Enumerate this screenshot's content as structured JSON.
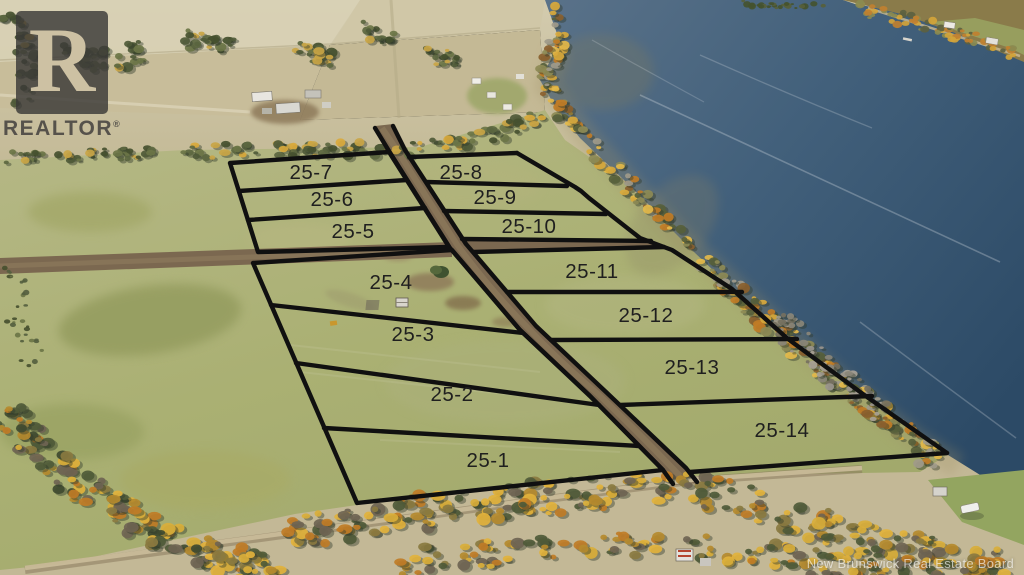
{
  "branding": {
    "logo_letter": "R",
    "logo_wordmark": "REALTOR",
    "registered_symbol": "®"
  },
  "watermark": {
    "text": "New Brunswick Real Estate Board"
  },
  "lot_labels": [
    "25-1",
    "25-2",
    "25-3",
    "25-4",
    "25-5",
    "25-6",
    "25-7",
    "25-8",
    "25-9",
    "25-10",
    "25-11",
    "25-12",
    "25-13",
    "25-14"
  ],
  "colors": {
    "boundary": "#101010",
    "lot-label": "#1f1f1f",
    "water-deep": "#304c66",
    "water-light": "#5a7289",
    "road-dirt": "#7b6850",
    "grass": "#aeb27e",
    "grass-dark": "#99a164",
    "field-tan": "#cbc09d",
    "autumn-yellow": "#d9ae3a",
    "autumn-orange": "#c07c26",
    "tree-dark": "#4f5a38",
    "watermark-white": "#ffffff"
  }
}
